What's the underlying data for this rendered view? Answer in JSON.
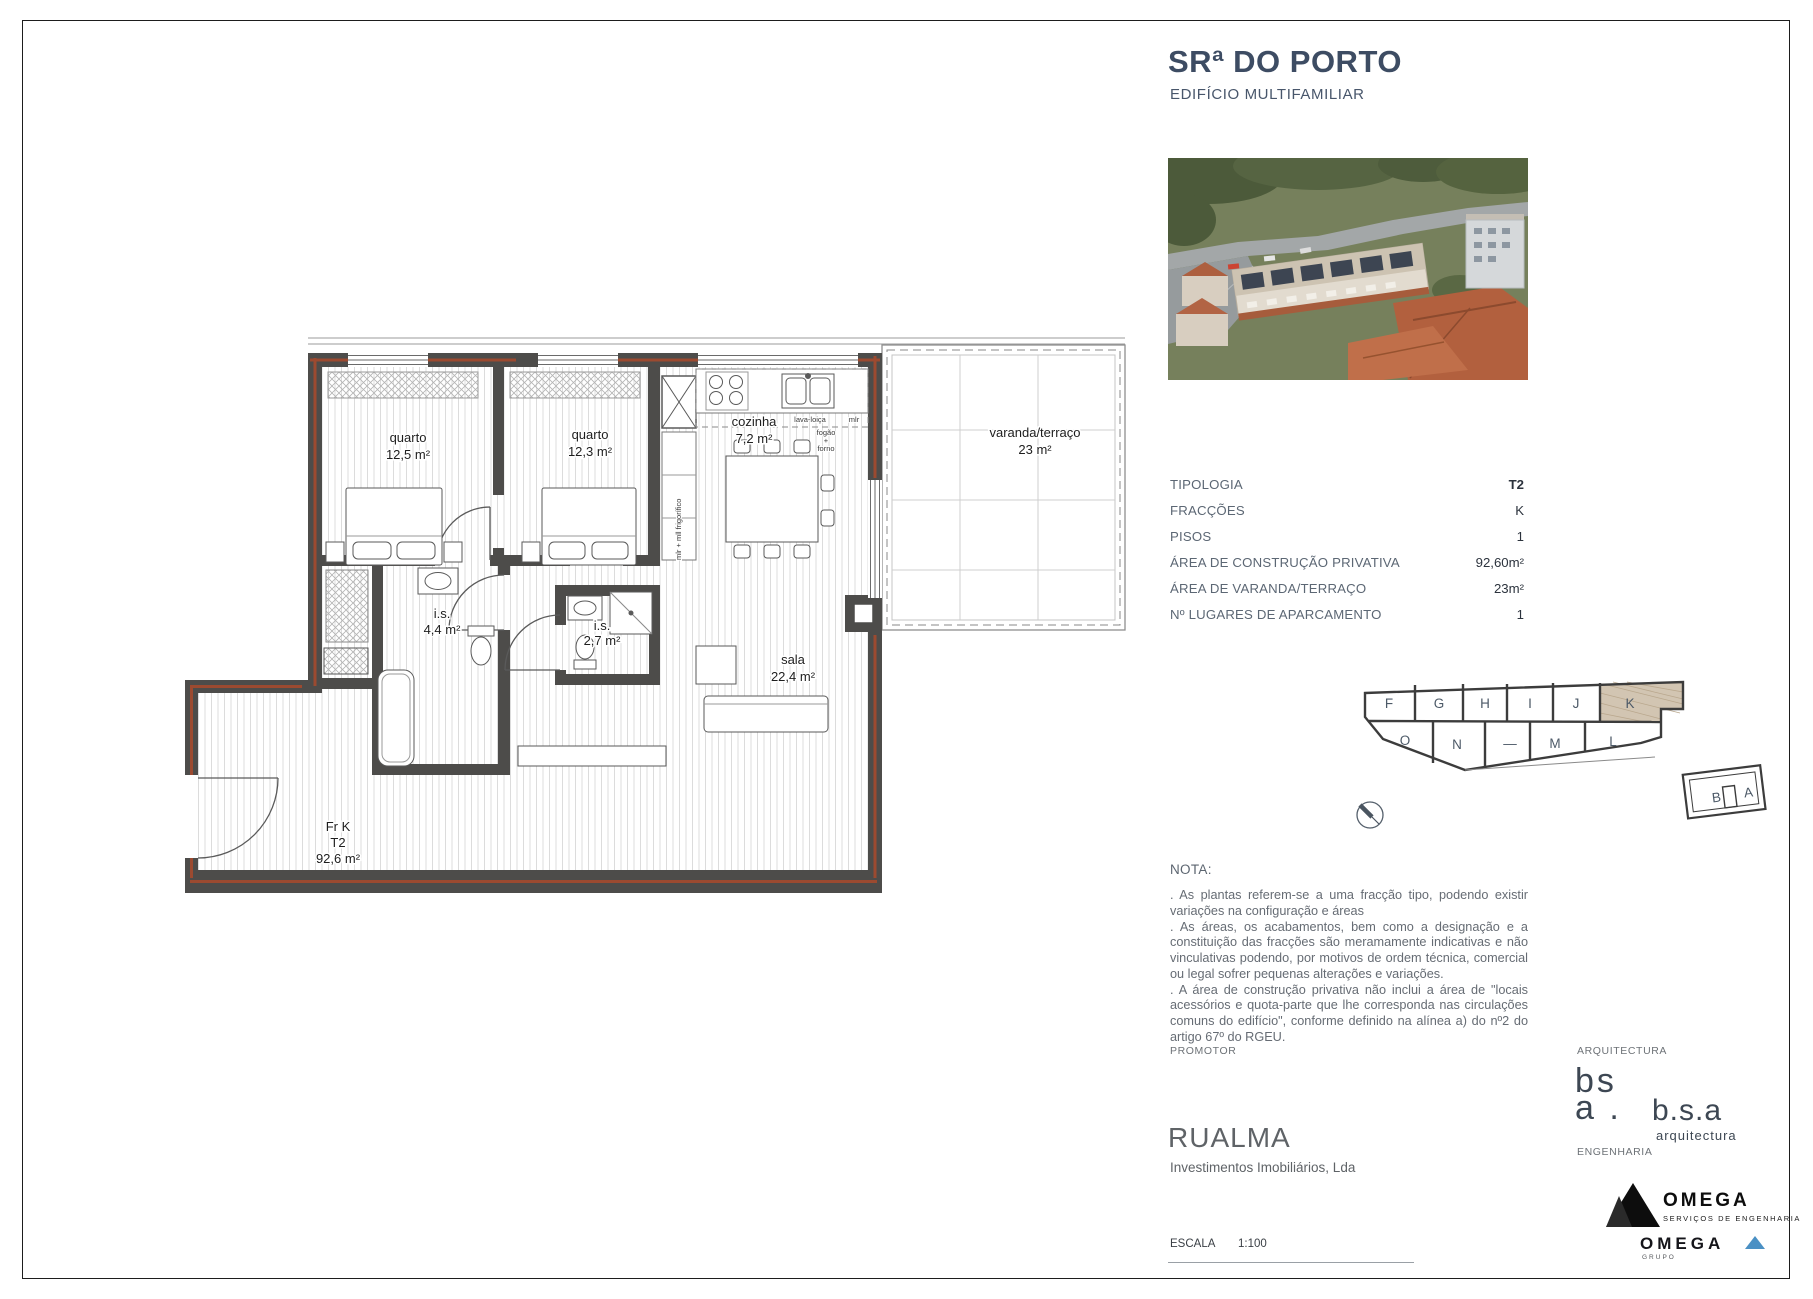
{
  "header": {
    "title": "SRª DO PORTO",
    "subtitle": "EDIFÍCIO MULTIFAMILIAR"
  },
  "specs": [
    {
      "label": "TIPOLOGIA",
      "value": "T2"
    },
    {
      "label": "FRACÇÕES",
      "value": "K"
    },
    {
      "label": "PISOS",
      "value": "1"
    },
    {
      "label": "ÁREA DE CONSTRUÇÃO PRIVATIVA",
      "value": "92,60m²"
    },
    {
      "label": "ÁREA DE VARANDA/TERRAÇO",
      "value": "23m²"
    },
    {
      "label": "Nº LUGARES DE APARCAMENTO",
      "value": "1"
    }
  ],
  "plan": {
    "quarto1_name": "quarto",
    "quarto1_area": "12,5 m²",
    "quarto2_name": "quarto",
    "quarto2_area": "12,3 m²",
    "cozinha_name": "cozinha",
    "cozinha_area": "7,2 m²",
    "varanda_name": "varanda/terraço",
    "varanda_area": "23 m²",
    "is1_name": "i.s.",
    "is1_area": "4,4 m²",
    "is2_name": "i.s.",
    "is2_area": "2,7 m²",
    "sala_name": "sala",
    "sala_area": "22,4 m²",
    "unit_line1": "Fr K",
    "unit_line2": "T2",
    "unit_line3": "92,6 m²",
    "k_stove_1": "fogão",
    "k_stove_2": "+",
    "k_stove_3": "forno",
    "k_sink": "lava-loiça",
    "k_mlr": "mlr",
    "k_appliances": "mlr + mll frigorífico"
  },
  "keyplan": {
    "units_top": [
      "F",
      "G",
      "H",
      "I",
      "J",
      "K"
    ],
    "units_bottom": [
      "O",
      "N",
      "M",
      "L"
    ],
    "separator": "—",
    "units_annex": [
      "B",
      "A"
    ],
    "highlighted_unit": "K"
  },
  "nota": {
    "heading": "NOTA:",
    "paragraphs": [
      ". As plantas referem-se a uma fracção tipo, podendo existir variações na configuração e áreas",
      ". As áreas, os acabamentos, bem como a designação e a constituição das fracções são meramamente indicativas e não vinculativas podendo, por motivos de ordem técnica, comercial ou legal sofrer pequenas alterações e variações.",
      ". A área de construção privativa não inclui a área de \"locais acessórios e quota-parte que lhe corresponda nas circulações comuns do edifício\", conforme definido na alínea a) do nº2 do artigo 67º do RGEU."
    ]
  },
  "footer": {
    "promoter_label": "PROMOTOR",
    "promoter_name": "RUALMA",
    "promoter_desc": "Investimentos Imobiliários, Lda",
    "architecture_label": "ARQUITECTURA",
    "architecture_mark_1": "bs",
    "architecture_mark_2": "a .",
    "architecture_name": "b.s.a",
    "architecture_field": "arquitectura",
    "engineering_label": "ENGENHARIA",
    "engineering_name": "OMEGA",
    "engineering_desc": "SERVIÇOS DE ENGENHARIA",
    "engineering_group_name": "OMEGA",
    "engineering_group_desc": "GRUPO",
    "scale_label": "ESCALA",
    "scale_value": "1:100"
  },
  "colors": {
    "brand_slate": "#3d4c63",
    "wall": "#4d4c4a",
    "wall_core": "#9c4a30",
    "unit_highlight": "#d2c5b2",
    "omega_blue": "#4a90c4"
  }
}
